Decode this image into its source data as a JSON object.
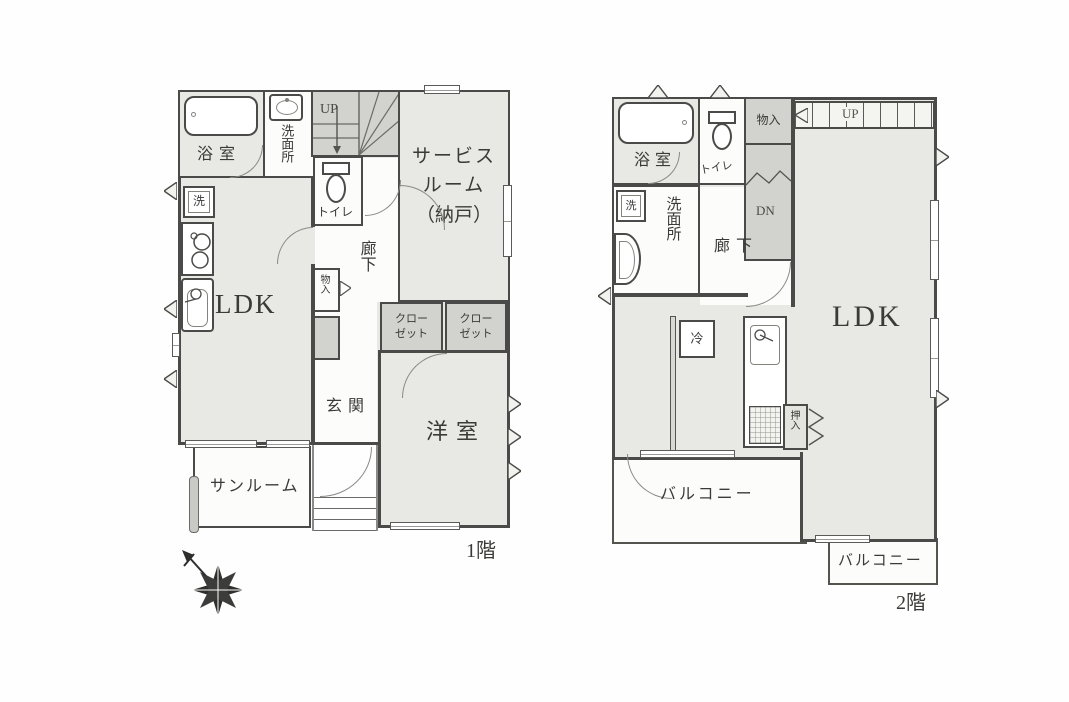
{
  "floor1": {
    "floor_label": "1階",
    "rooms": {
      "bath": "浴室",
      "washroom": "洗面所",
      "toilet": "トイレ",
      "stairs_up": "UP",
      "service_line1": "サービス",
      "service_line2": "ルーム",
      "service_line3": "（納戸）",
      "washer": "洗",
      "ldk": "LDK",
      "hallway": "廊下",
      "storage": "物入",
      "entrance": "玄関",
      "closet_line1": "クロー",
      "closet_line2": "ゼット",
      "western_room": "洋室",
      "sunroom": "サンルーム"
    }
  },
  "floor2": {
    "floor_label": "2階",
    "rooms": {
      "bath": "浴室",
      "toilet": "トイレ",
      "storage": "物入",
      "stairs_up": "UP",
      "stairs_down": "DN",
      "washer": "洗",
      "washroom": "洗面所",
      "hallway": "廊下",
      "ldk": "LDK",
      "fridge": "冷",
      "futon_closet": "押入",
      "balcony_main": "バルコニー",
      "balcony_sub": "バルコニー"
    }
  },
  "colors": {
    "wall": "#4a4a48",
    "room_fill": "#e8e8e4",
    "shaded_fill": "#d2d2ce",
    "text": "#3a3a38"
  }
}
